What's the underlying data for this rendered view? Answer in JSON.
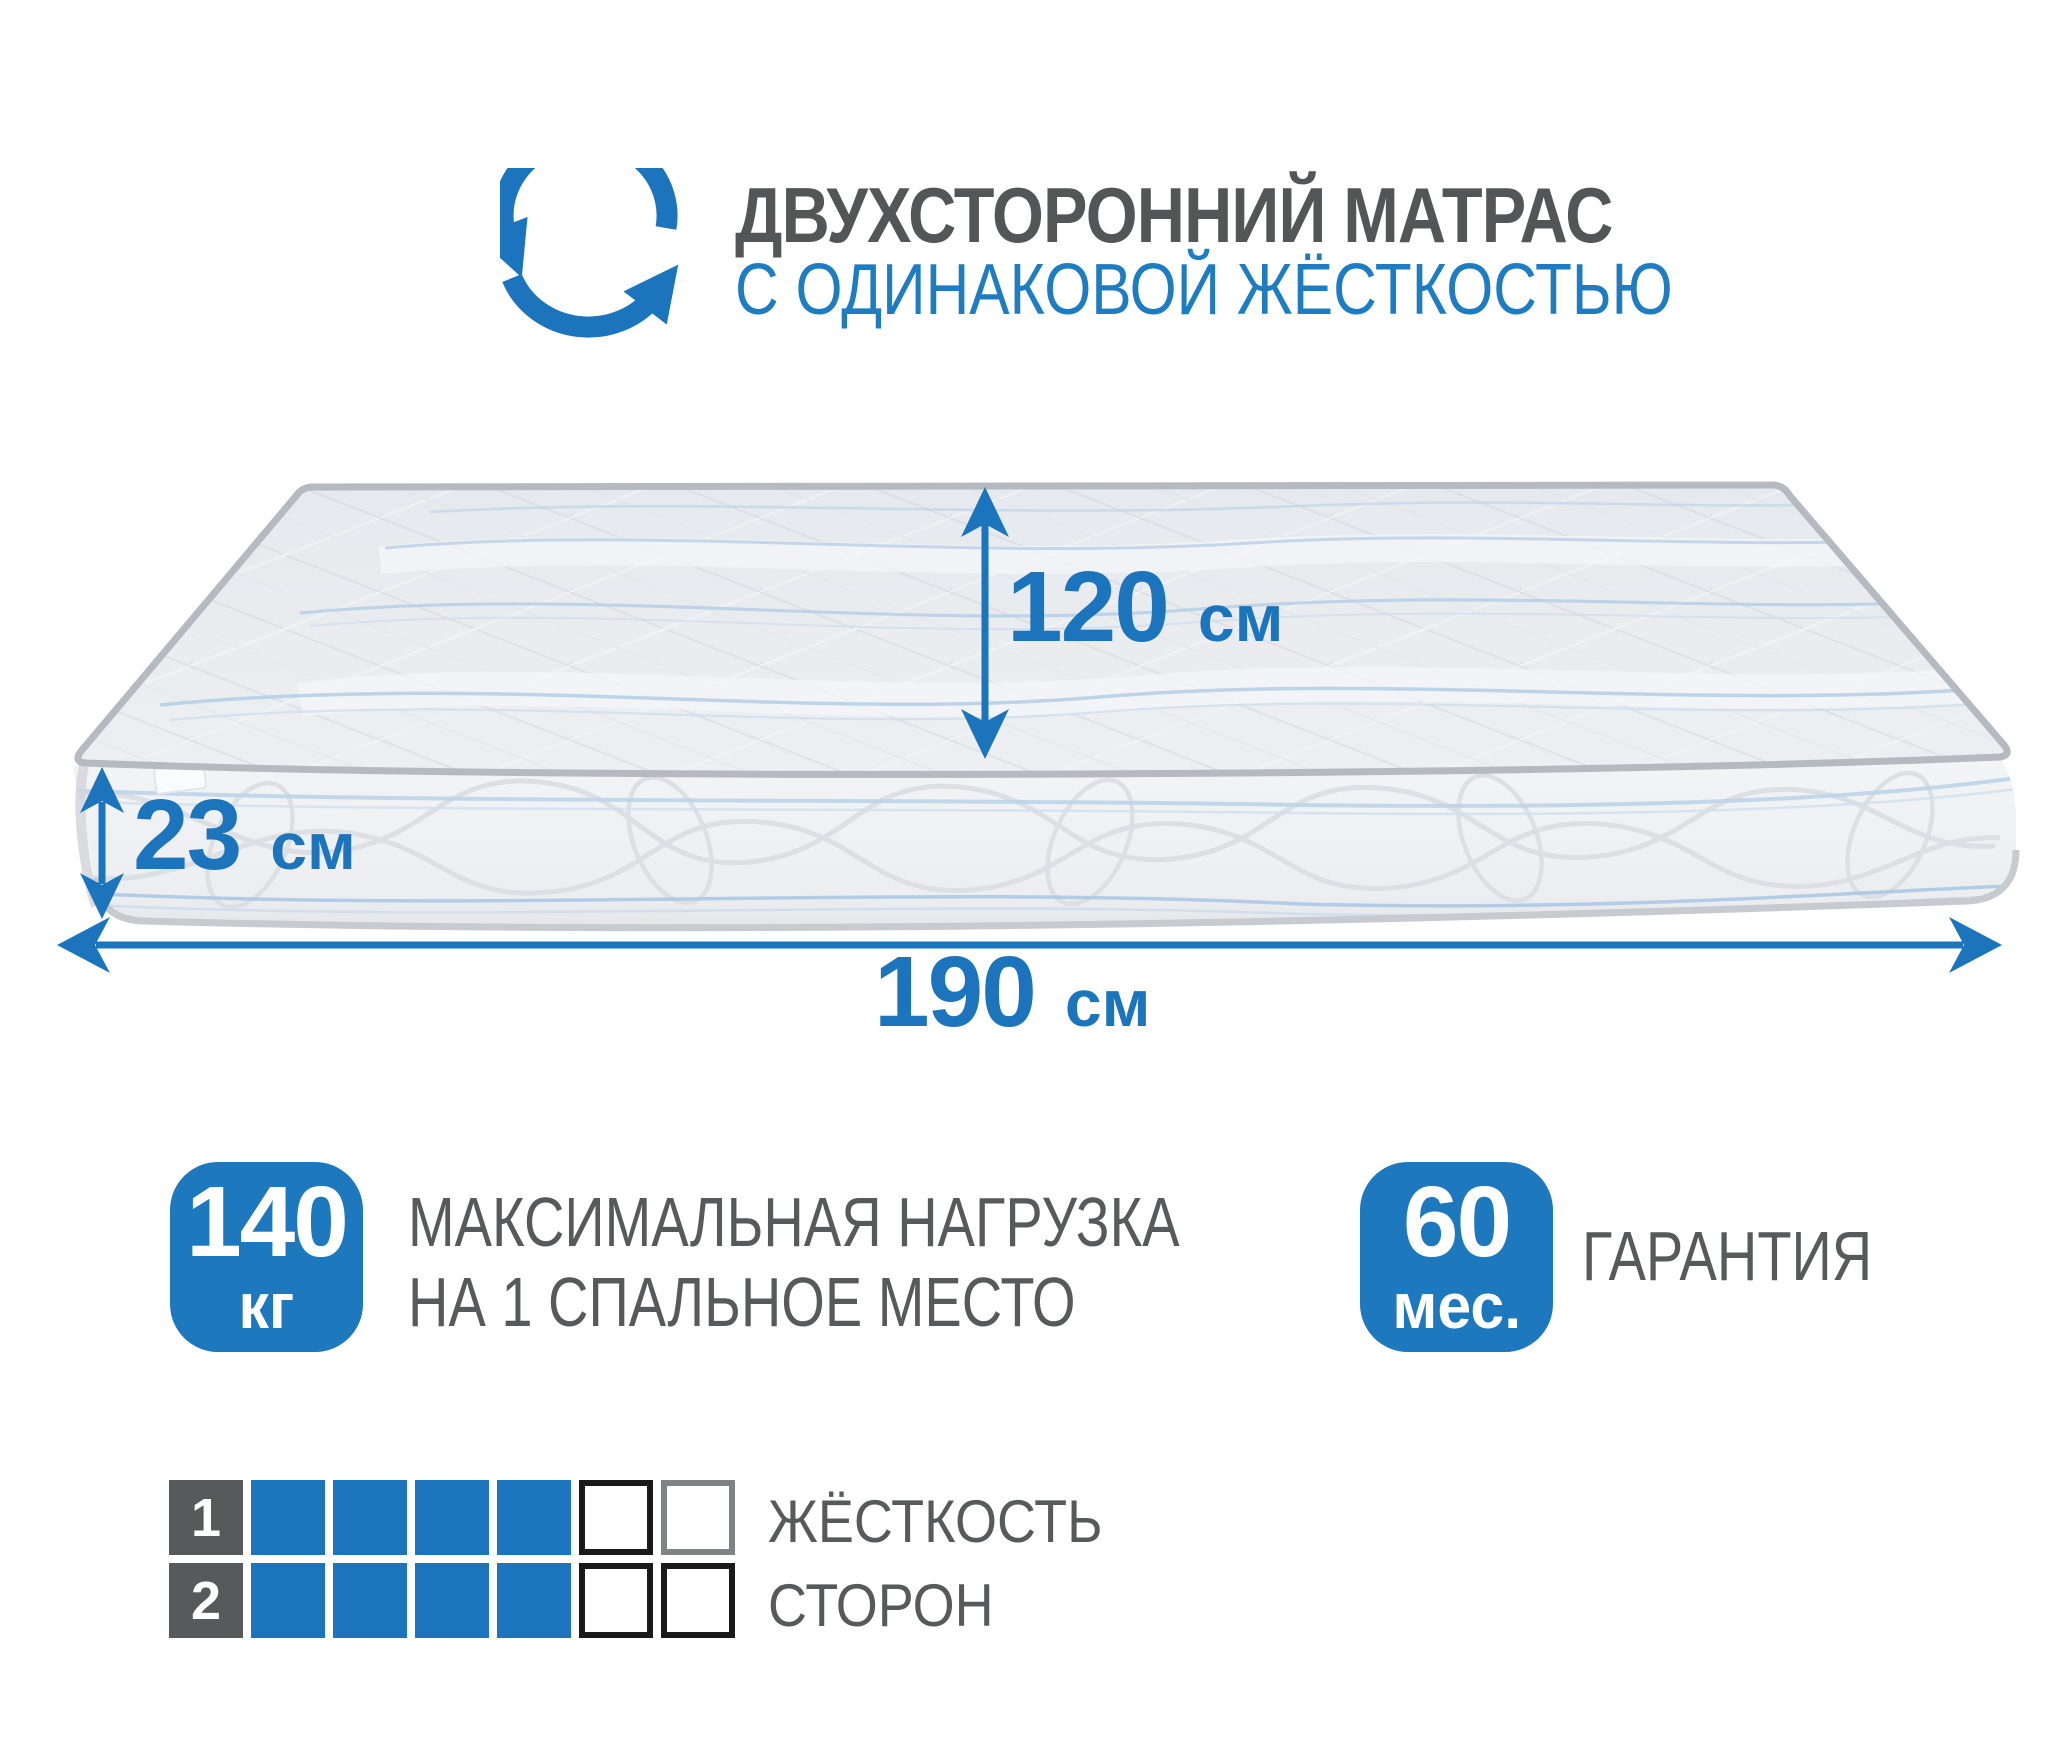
{
  "colors": {
    "accent_blue": "#1C75BC",
    "heading_blue": "#1E7DC2",
    "badge_blue": "#1D78BE",
    "text_gray": "#58595B",
    "title_gray": "#545557",
    "scale_gray": "#58595B"
  },
  "header": {
    "title": "ДВУХСТОРОННИЙ МАТРАС",
    "subtitle": "С ОДИНАКОВОЙ ЖЁСТКОСТЬЮ",
    "icon": "rotate-arrows-icon"
  },
  "dimensions": {
    "width": {
      "value": "120",
      "unit": "см"
    },
    "height": {
      "value": "23",
      "unit": "см"
    },
    "length": {
      "value": "190",
      "unit": "см"
    }
  },
  "badges": {
    "max_load": {
      "value": "140",
      "unit": "кг",
      "label_line1": "МАКСИМАЛЬНАЯ НАГРУЗКА",
      "label_line2": "НА 1 СПАЛЬНОЕ МЕСТО"
    },
    "warranty": {
      "value": "60",
      "unit": "мес.",
      "label": "ГАРАНТИЯ"
    }
  },
  "firmness_scale": {
    "label_line1": "ЖЁСТКОСТЬ",
    "label_line2": "СТОРОН",
    "cells_total": 6,
    "rows": [
      {
        "side": "1",
        "filled": 4,
        "empty_border_colors": [
          "#1a1a1a",
          "#808285"
        ]
      },
      {
        "side": "2",
        "filled": 4,
        "empty_border_colors": [
          "#1a1a1a",
          "#1a1a1a"
        ]
      }
    ]
  }
}
